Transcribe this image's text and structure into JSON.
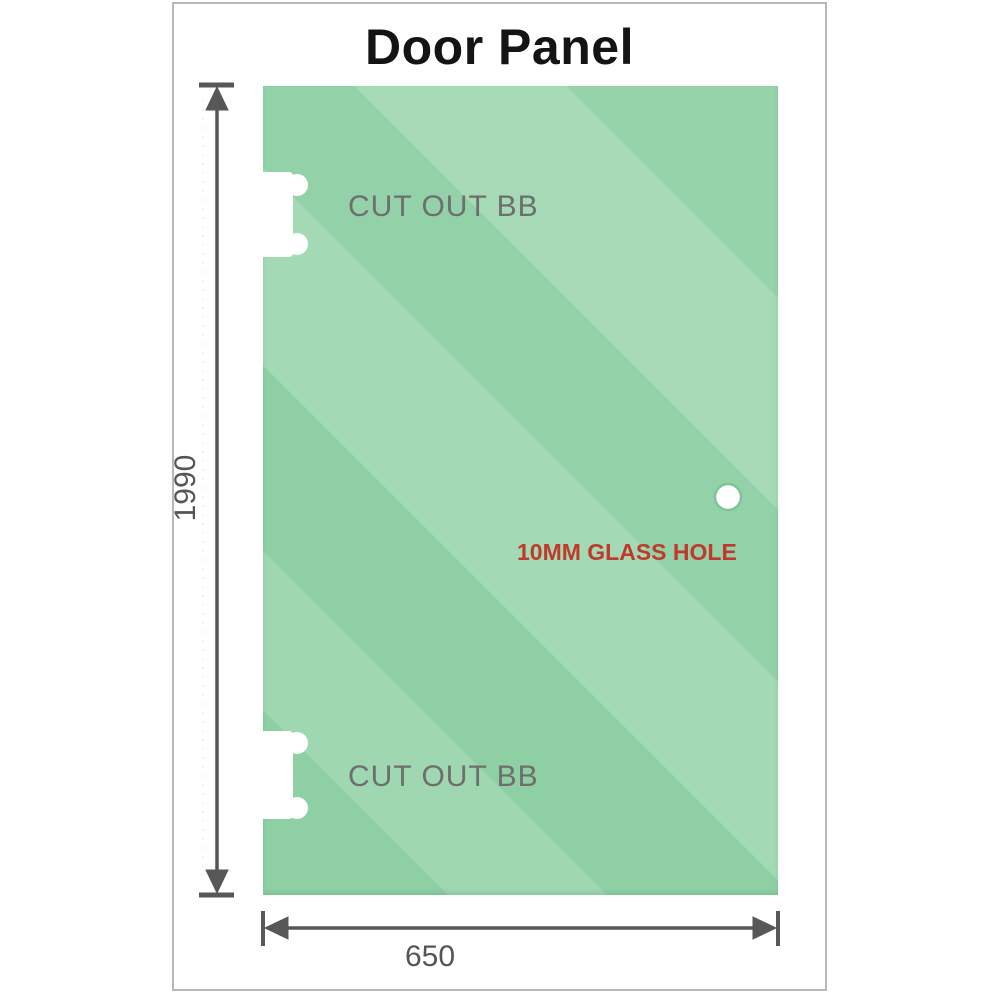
{
  "title": "Door Panel",
  "panel": {
    "cutouts": [
      {
        "label": "CUT OUT BB"
      },
      {
        "label": "CUT OUT BB"
      }
    ],
    "hole": {
      "label": "10MM GLASS HOLE"
    }
  },
  "dimensions": {
    "height": "1990",
    "width": "650"
  },
  "colors": {
    "glass_green": "#87cd9e",
    "glass_highlight": "#aadebd",
    "hole_label_red": "#c03a2b",
    "cutout_label_gray": "#6e6e6e",
    "dimension_gray": "#575757",
    "frame_border_gray": "#b8b8b8",
    "title_black": "#141414"
  }
}
